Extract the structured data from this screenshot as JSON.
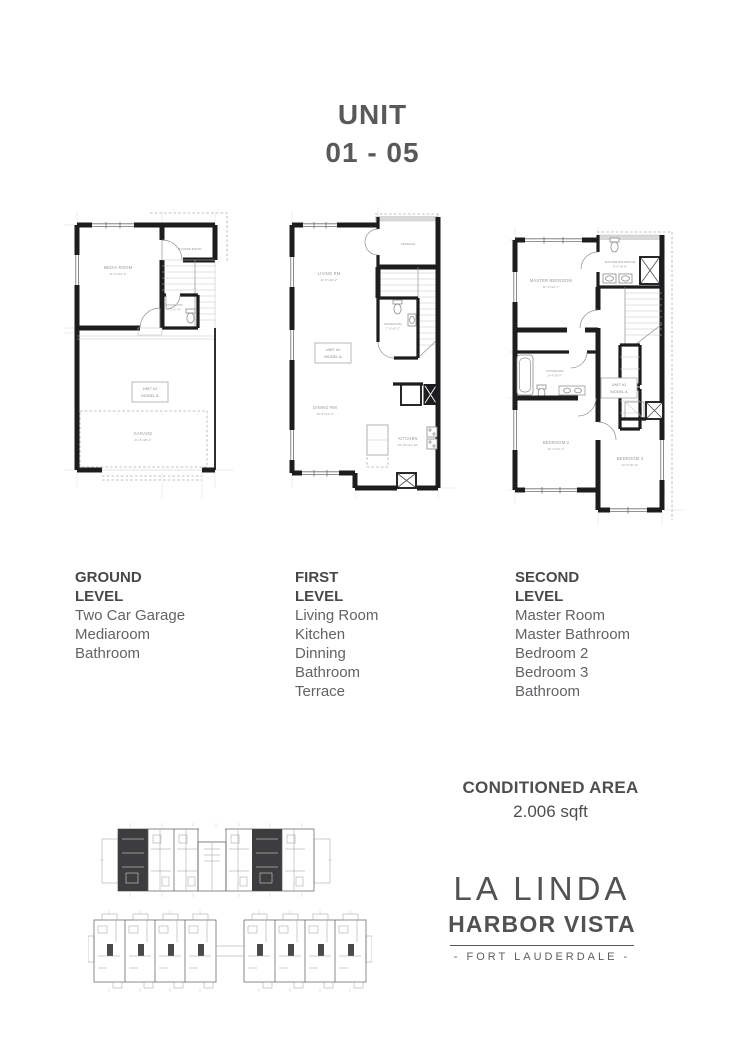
{
  "title": {
    "line1": "UNIT",
    "line2": "01 - 05"
  },
  "plans": {
    "ground": {
      "media_room": {
        "name": "MEDIA ROOM",
        "dims": "11'-5\"x14'-5\""
      },
      "roofed_entry": {
        "name": "ROOFED ENTRY"
      },
      "bathroom": {
        "name": "BATHROOM",
        "dims": "5'-2\"x7'-0\""
      },
      "garage": {
        "name": "GARAGE",
        "dims": "21'-3\"x20'-1\""
      },
      "unit_label": {
        "line1": "UNIT #1",
        "line2": "MODEL A"
      }
    },
    "first": {
      "living": {
        "name": "LIVING RM",
        "dims": "11'-5\"x19'-2\""
      },
      "terrace": {
        "name": "TERRACE"
      },
      "bathroom": {
        "name": "BATHROOM",
        "dims": "7'-3\"x5'-2\""
      },
      "dining": {
        "name": "DINING RM",
        "dims": "10'-5\"x14'-4\""
      },
      "kitchen": {
        "name": "KITCHEN",
        "dims": "10'-10\"x11'-10\""
      },
      "unit_label": {
        "line1": "UNIT #1",
        "line2": "MODEL A"
      }
    },
    "second": {
      "master_bedroom": {
        "name": "MASTER BEDROOM",
        "dims": "11'-4\"x12'-7\""
      },
      "master_bathroom": {
        "name": "MASTER BATHROOM",
        "dims": "9'-4\"x5'-0\""
      },
      "bathroom": {
        "name": "BATHROOM",
        "dims": "8'-4\"x5'-0\""
      },
      "bedroom_2": {
        "name": "BEDROOM 2",
        "dims": "11'-4\"x11'-2\""
      },
      "bedroom_3": {
        "name": "BEDROOM 3",
        "dims": "12'-0\"x8'-11\""
      },
      "unit_label": {
        "line1": "UNIT #1",
        "line2": "MODEL A"
      }
    }
  },
  "levels": [
    {
      "line1": "GROUND",
      "line2": "LEVEL",
      "items": [
        "Two Car Garage",
        "Mediaroom",
        "Bathroom"
      ]
    },
    {
      "line1": "FIRST",
      "line2": "LEVEL",
      "items": [
        "Living Room",
        "Kitchen",
        "Dinning",
        "Bathroom",
        "Terrace"
      ]
    },
    {
      "line1": "SECOND",
      "line2": "LEVEL",
      "items": [
        "Master Room",
        "Master Bathroom",
        "Bedroom 2",
        "Bedroom 3",
        "Bathroom"
      ]
    }
  ],
  "conditioned_area": {
    "label": "CONDITIONED AREA",
    "value": "2.006 sqft"
  },
  "logo": {
    "name": "LA LINDA",
    "sub": "HARBOR VISTA",
    "tagline": "- FORT LAUDERDALE -"
  },
  "colors": {
    "accent_text": "#58595b",
    "wall": "#1d1d1f",
    "plan_label": "#9a9a9b",
    "dark_unit_fill": "#3d3d3f"
  }
}
